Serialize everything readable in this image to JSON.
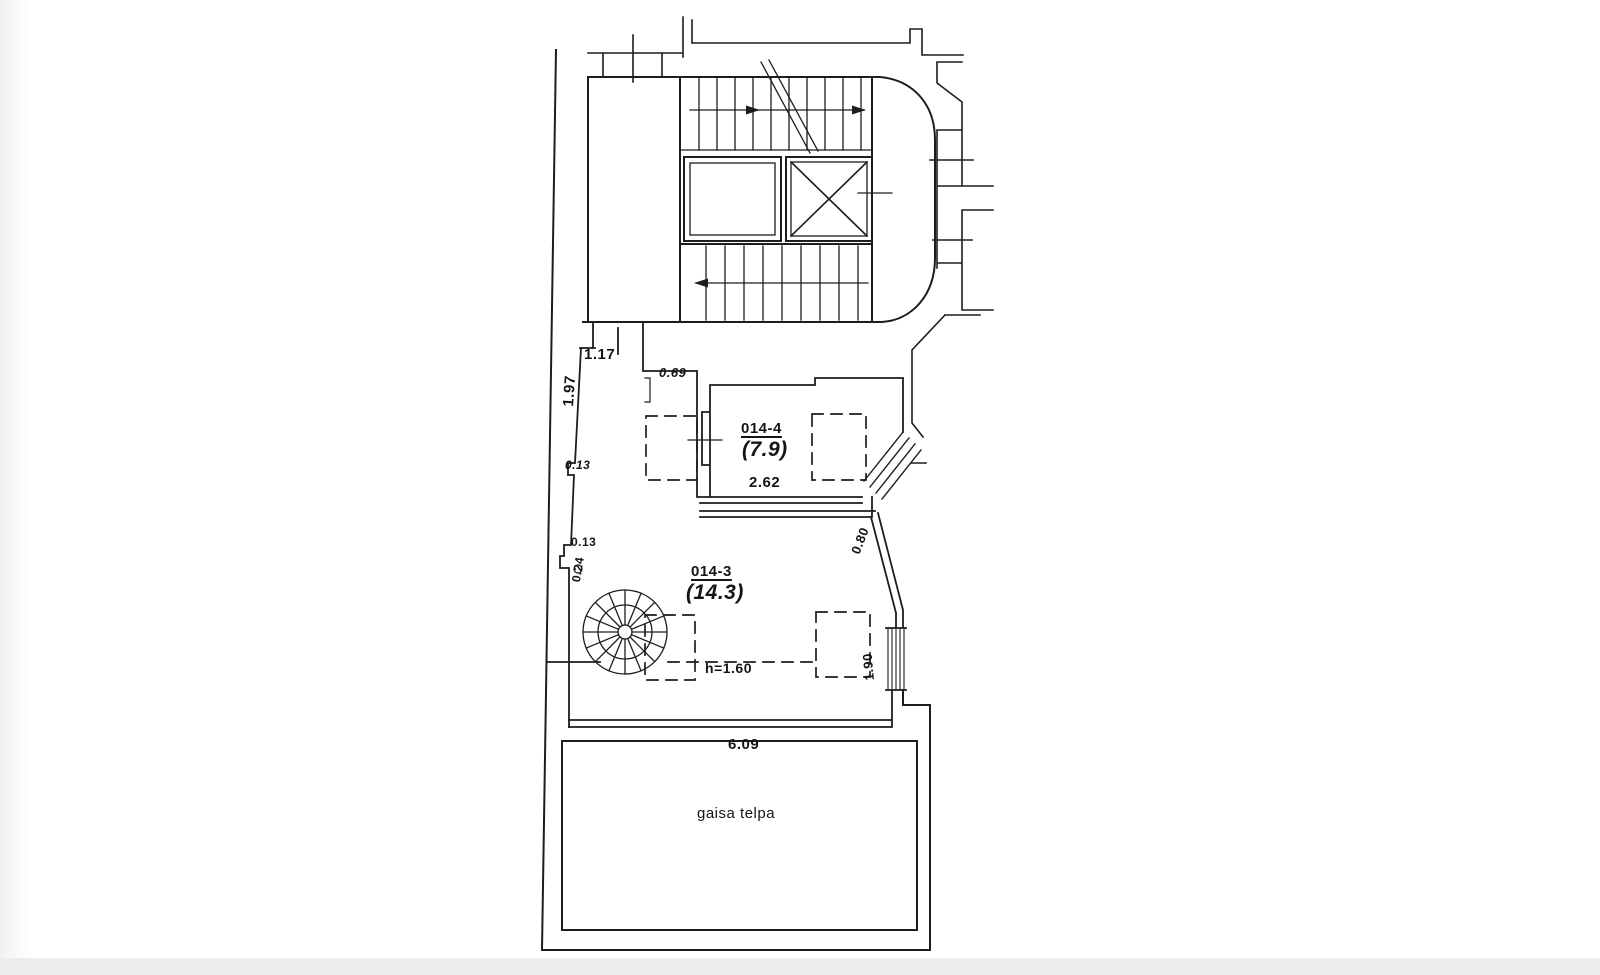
{
  "plan": {
    "rooms": [
      {
        "id": "014-4",
        "area": "(7.9)"
      },
      {
        "id": "014-3",
        "area": "(14.3)"
      },
      {
        "name": "gaisa telpa"
      }
    ],
    "dimensions": {
      "stair_opening": "1.17",
      "west_wall": "1.97",
      "step": "0.69",
      "offset_a": "0.13",
      "room4_width": "2.62",
      "offset_b": "0.13",
      "jog": "0.24",
      "diagonal_wall": "0.80",
      "low_ceiling": "h=1.60",
      "window": "1.90",
      "void_width": "6.09"
    },
    "colors": {
      "line": "#1d1d1d",
      "paper": "#ffffff",
      "margin": "#ececee"
    }
  }
}
